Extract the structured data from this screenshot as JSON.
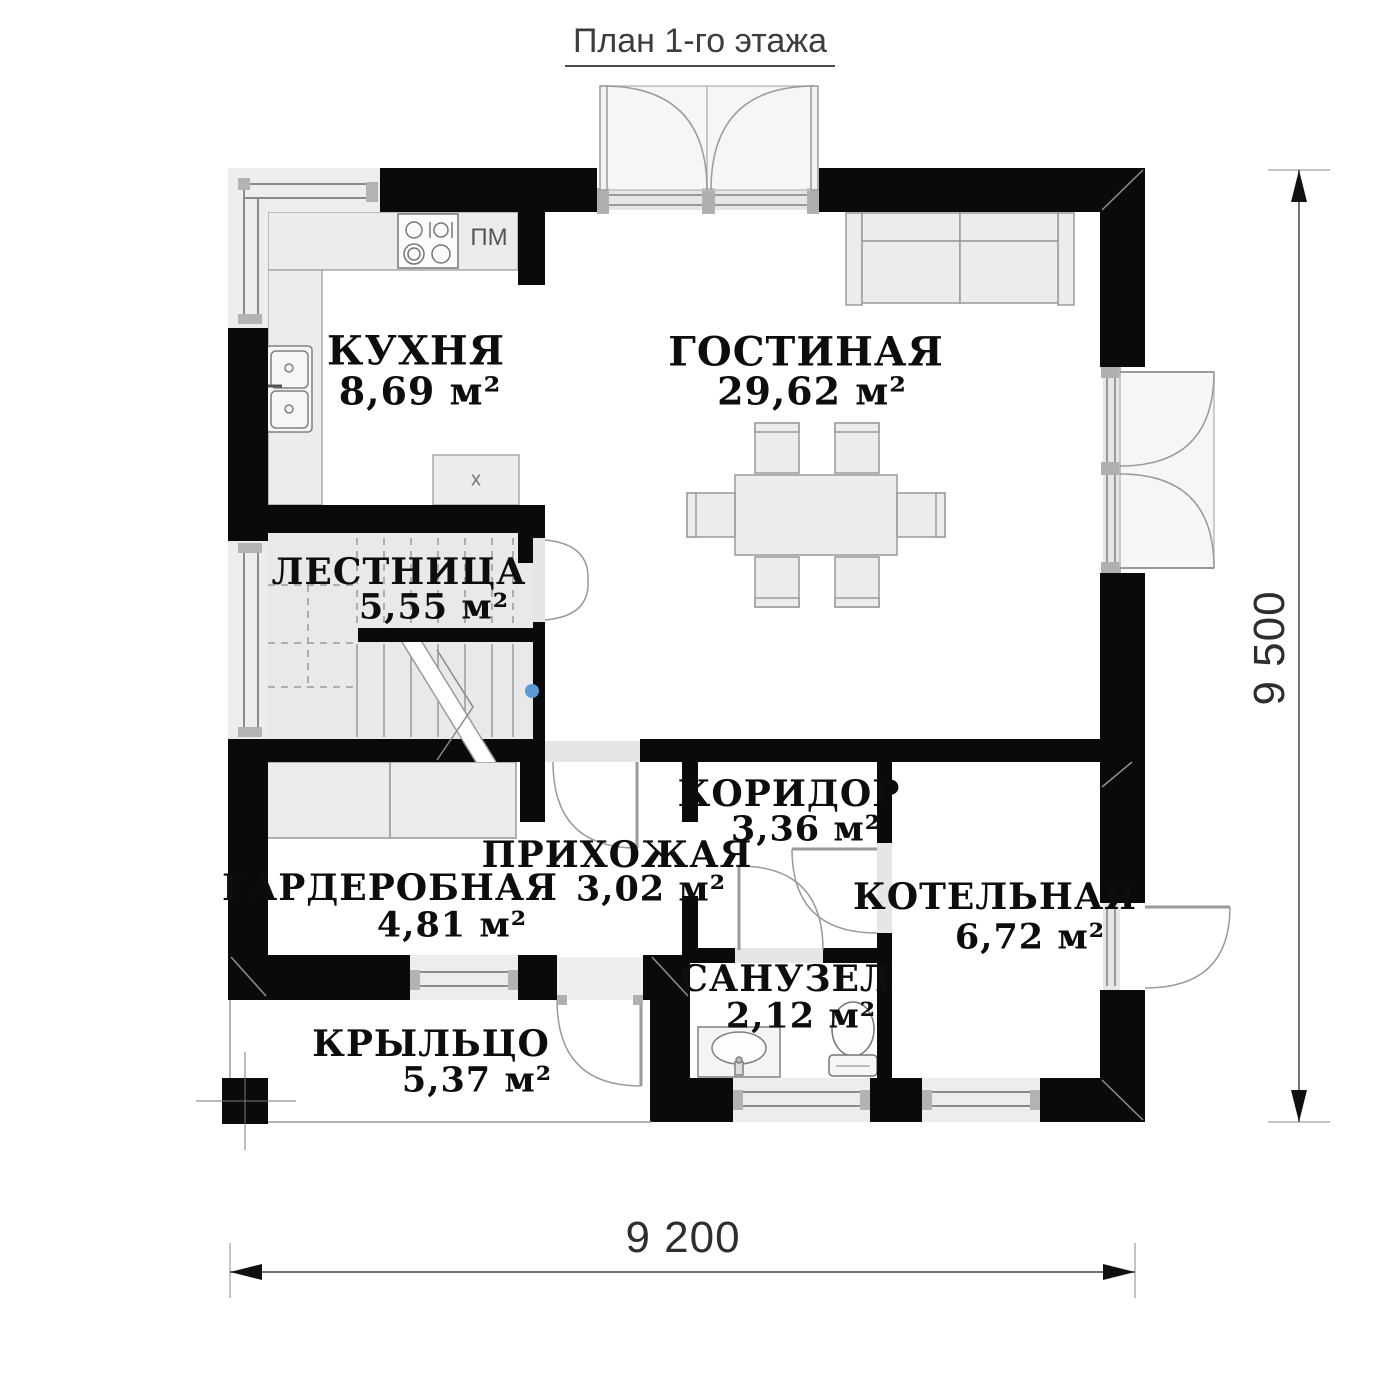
{
  "title": "План 1-го этажа",
  "rooms": [
    {
      "name": "КУХНЯ",
      "area": "8,69 м²"
    },
    {
      "name": "ГОСТИНАЯ",
      "area": "29,62 м²"
    },
    {
      "name": "ЛЕСТНИЦА",
      "area": "5,55 м²"
    },
    {
      "name": "КОРИДОР",
      "area": "3,36 м²"
    },
    {
      "name": "ПРИХОЖАЯ",
      "area": "3,02 м²"
    },
    {
      "name": "ГАРДЕРОБНАЯ",
      "area": "4,81 м²"
    },
    {
      "name": "КОТЕЛЬНАЯ",
      "area": "6,72 м²"
    },
    {
      "name": "САНУЗЕЛ",
      "area": "2,12 м²"
    },
    {
      "name": "КРЫЛЬЦО",
      "area": "5,37 м²"
    }
  ],
  "dimensions": {
    "width": "9 200",
    "height": "9 500"
  },
  "annotations": {
    "dishwasher": "ПМ",
    "fridge_mark": "x"
  },
  "colors": {
    "wall": "#0a0a0a",
    "fixture_fill": "#ececec",
    "line": "#999999",
    "handle_dot": "#5b9bd5"
  }
}
